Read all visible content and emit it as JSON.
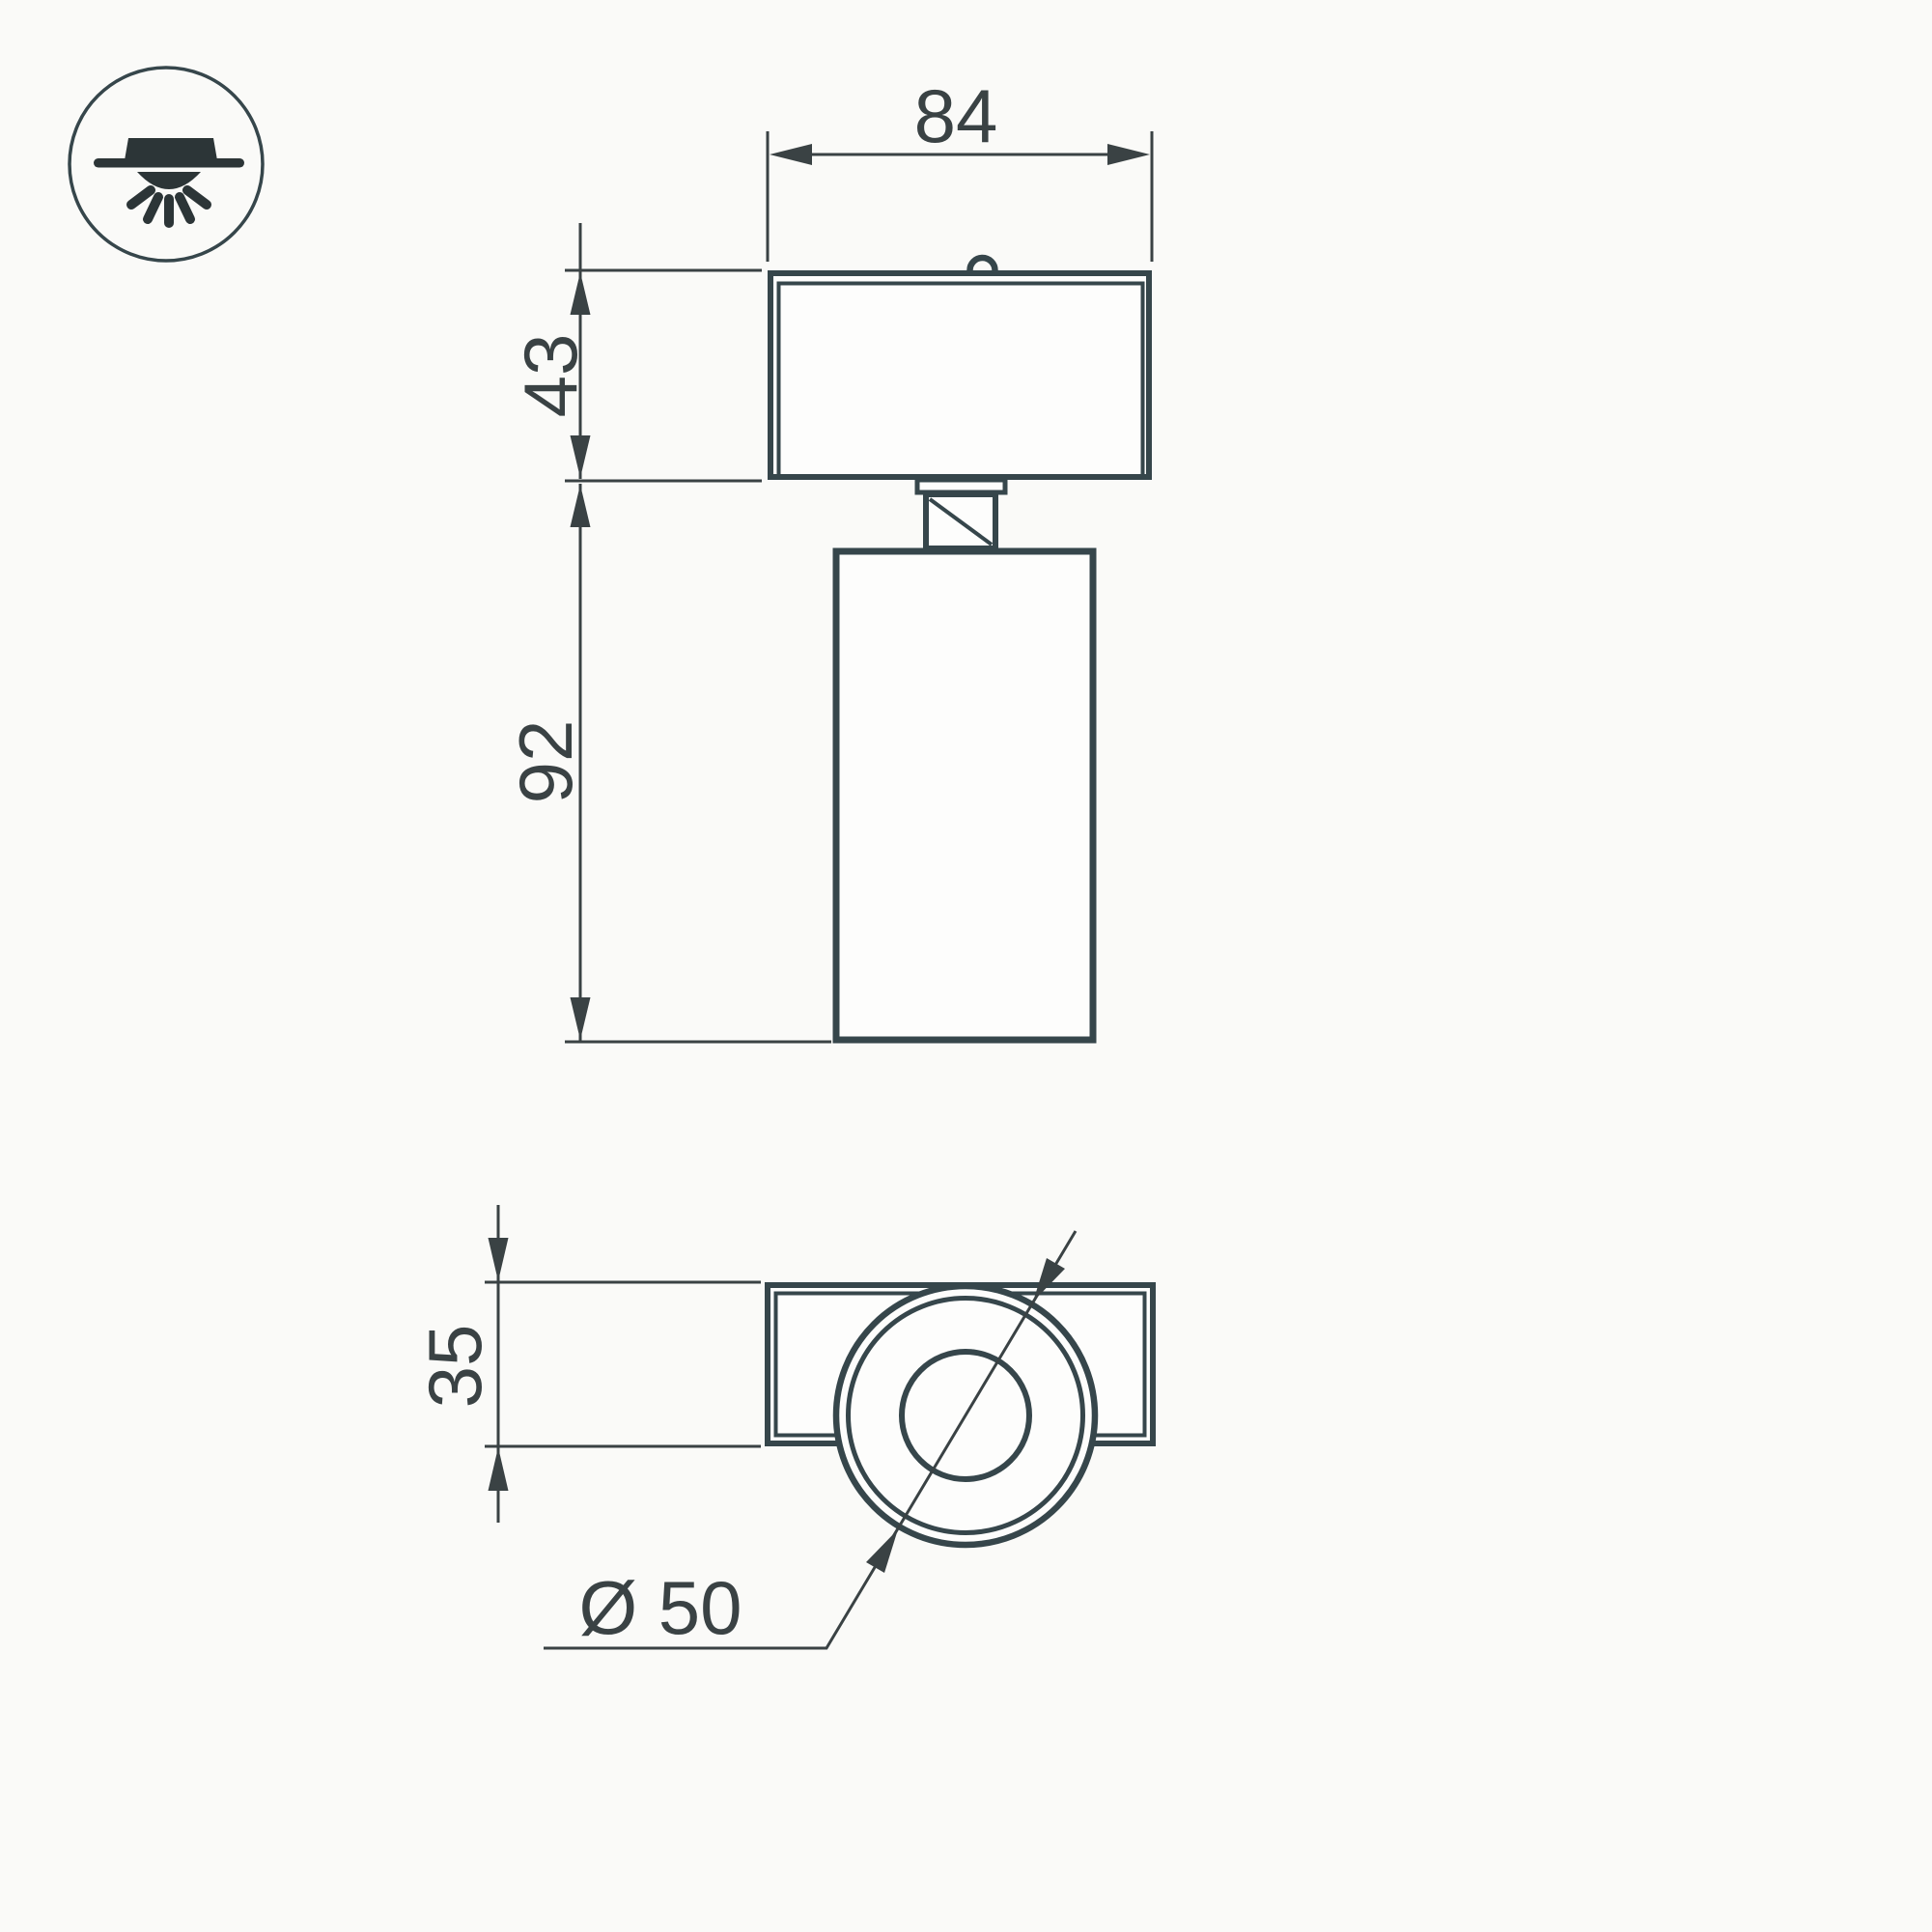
{
  "drawing": {
    "type": "technical-dimension-drawing",
    "subject": "ceiling-spot-luminaire",
    "colors": {
      "ink": "#36464b",
      "dimension": "#3a4244",
      "icon": "#2c3537",
      "background": "#fafaf8"
    },
    "icon": {
      "name": "surface-mounted-downlight-icon"
    },
    "views": {
      "front": "front-elevation-view",
      "plan": "bottom-plan-view"
    },
    "dimensions": {
      "head_width": "84",
      "head_height": "43",
      "body_height": "92",
      "base_depth": "35",
      "diameter": "Ø 50"
    }
  }
}
